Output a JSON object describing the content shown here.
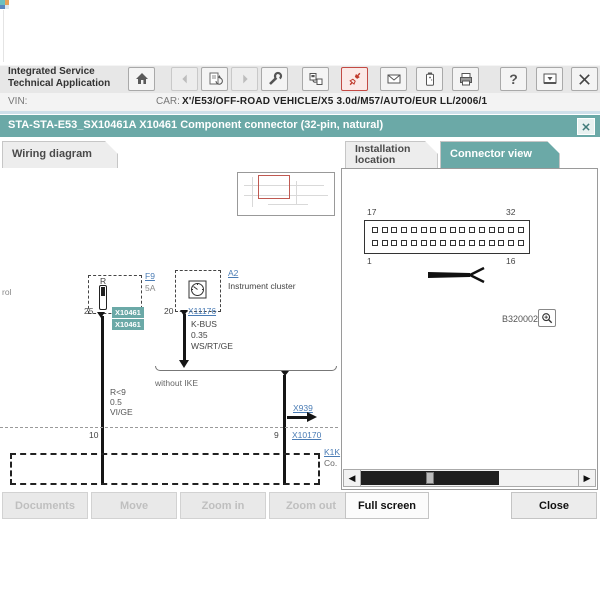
{
  "header": {
    "app_title_line1": "Integrated Service",
    "app_title_line2": "Technical Application",
    "vin_label": "VIN:",
    "car_label": "CAR:",
    "car_value": "X'/E53/OFF-ROAD VEHICLE/X5 3.0d/M57/AUTO/EUR LL/2006/1",
    "toolbar_icons": [
      "home-icon",
      "back-icon",
      "document-refresh-icon",
      "forward-icon",
      "wrench-icon",
      "connection-icon",
      "connector-plug-icon",
      "mail-icon",
      "battery-icon",
      "printer-icon",
      "help-icon",
      "screen-icon",
      "close-icon"
    ]
  },
  "dialog": {
    "title": "STA-STA-E53_SX10461A X10461 Component connector (32-pin, natural)"
  },
  "tabs": {
    "wiring": "Wiring diagram",
    "installation_line1": "Installation",
    "installation_line2": "location",
    "connector": "Connector view"
  },
  "wiring_diagram": {
    "left_edge_text": "rol",
    "fuse_block": {
      "label": "R",
      "link": "F9",
      "rating": "5A",
      "pin_top": "25",
      "tags": [
        "X10461",
        "X10461"
      ],
      "pin_bottom": "10"
    },
    "cluster_block": {
      "link": "A2",
      "name": "Instrument cluster",
      "pin_top": "20",
      "connector_link": "X11176",
      "bus": "K-BUS",
      "cross_section": "0.35",
      "color_code": "WS/RT/GE"
    },
    "note": "without IKE",
    "wire_label": {
      "line1": "R<9",
      "line2": "0.5",
      "line3": "VI/GE"
    },
    "x939_link": "X939",
    "pin9": "9",
    "x10170_link": "X10170",
    "k1k_link": "K1K",
    "k1k_sub": "Co."
  },
  "connector_view": {
    "pins_per_row": 16,
    "labels": {
      "top_left": "17",
      "top_right": "32",
      "bottom_left": "1",
      "bottom_right": "16"
    },
    "figure_id": "B320002",
    "zoom_icon": "magnifier-icon"
  },
  "footer_buttons": {
    "documents": {
      "label": "Documents",
      "enabled": false
    },
    "move": {
      "label": "Move",
      "enabled": false
    },
    "zoom_in": {
      "label": "Zoom in",
      "enabled": false
    },
    "zoom_out": {
      "label": "Zoom out",
      "enabled": false
    },
    "full_screen": {
      "label": "Full screen",
      "enabled": true
    },
    "close": {
      "label": "Close",
      "enabled": true
    }
  },
  "colors": {
    "teal": "#6BA9A7",
    "link_blue": "#4A7CB5",
    "red_accent": "#C34A44",
    "wire_black": "#151515"
  }
}
